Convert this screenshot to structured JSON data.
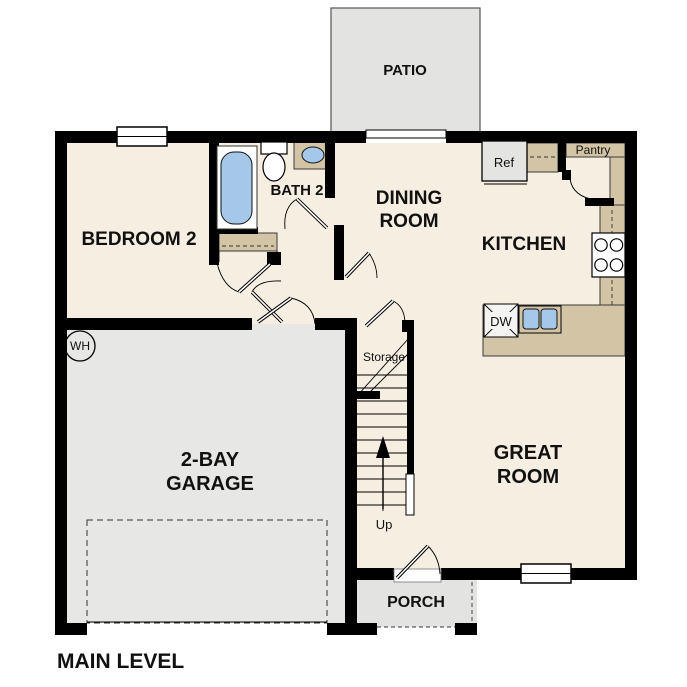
{
  "title": "MAIN LEVEL",
  "rooms": {
    "patio": "PATIO",
    "bedroom2": "BEDROOM 2",
    "bath2": "BATH 2",
    "dining_line1": "DINING",
    "dining_line2": "ROOM",
    "kitchen": "KITCHEN",
    "great_line1": "GREAT",
    "great_line2": "ROOM",
    "garage_line1": "2-BAY",
    "garage_line2": "GARAGE",
    "porch": "PORCH"
  },
  "labels": {
    "pantry": "Pantry",
    "ref": "Ref",
    "dw": "DW",
    "storage": "Storage",
    "up": "Up",
    "water_heater": "WH"
  },
  "colors": {
    "wall": "#000000",
    "interior_floor": "#f6eee0",
    "garage_floor": "#e7e7e5",
    "outdoor_floor": "#e3e3e1",
    "counter_tan": "#d3c4a5",
    "fixture_blue": "#a5c8e9",
    "appliance_gray": "#e4e4e3",
    "background": "#ffffff"
  }
}
